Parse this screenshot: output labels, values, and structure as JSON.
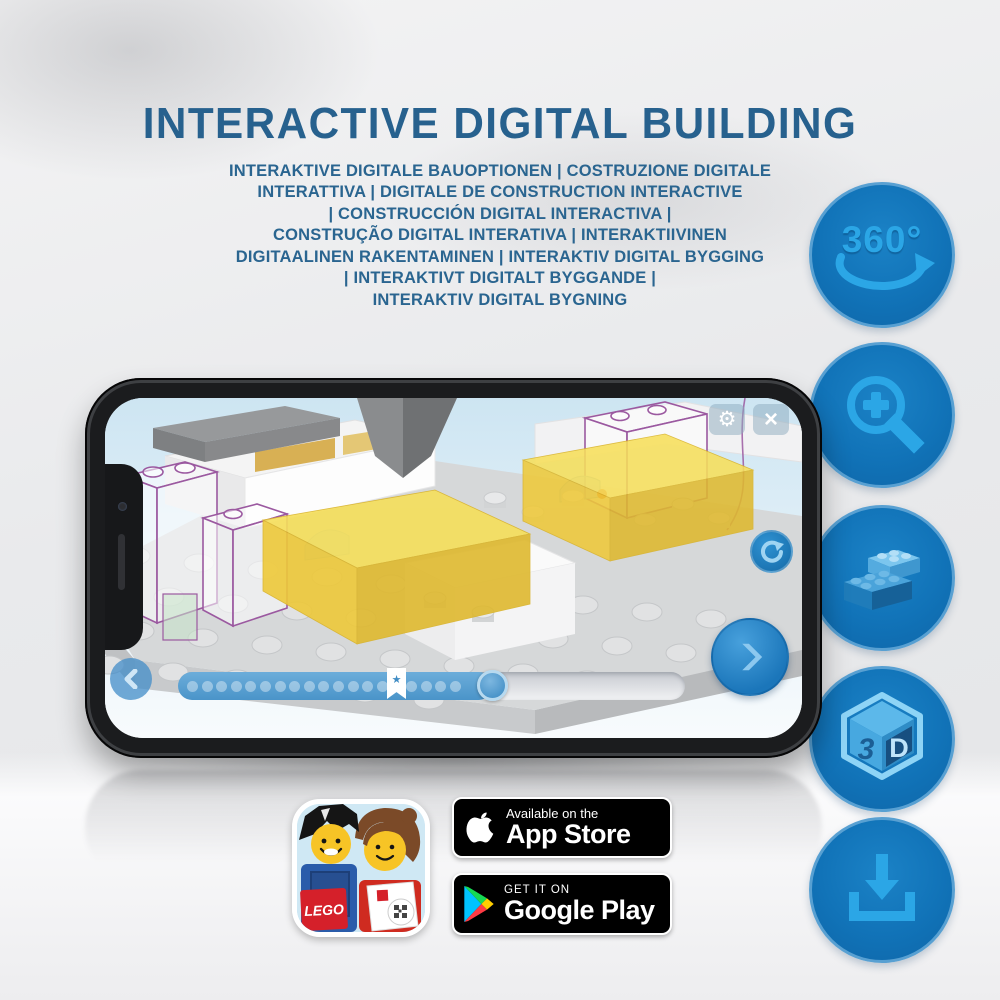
{
  "header": {
    "title": "INTERACTIVE DIGITAL BUILDING",
    "subtitle_lines": [
      "INTERAKTIVE DIGITALE BAUOPTIONEN | COSTRUZIONE DIGITALE",
      "INTERATTIVA | DIGITALE DE CONSTRUCTION INTERACTIVE",
      "| CONSTRUCCIÓN DIGITAL INTERACTIVA |",
      "CONSTRUÇÃO DIGITAL INTERATIVA | INTERAKTIIVINEN",
      "DIGITAALINEN RAKENTAMINEN | INTERAKTIV DIGITAL BYGGING",
      "| INTERAKTIVT DIGITALT BYGGANDE |",
      "INTERAKTIV DIGITAL BYGNING"
    ]
  },
  "feature_icons": [
    {
      "id": "360-rotation",
      "text": "360°"
    },
    {
      "id": "zoom-in"
    },
    {
      "id": "brick-stack"
    },
    {
      "id": "3d-cube",
      "face_left": "3",
      "face_right": "D"
    },
    {
      "id": "download"
    }
  ],
  "phone_app": {
    "icons": {
      "settings": "⚙",
      "close": "×",
      "bookmark_star": "★"
    },
    "progress": {
      "percent_complete": 62,
      "step_dots": 19,
      "bookmark_position_percent": 43
    }
  },
  "badges": {
    "app_store": {
      "tagline": "Available on the",
      "store": "App Store"
    },
    "google_play": {
      "tagline": "GET IT ON",
      "store": "Google Play"
    }
  },
  "app_icon": {
    "logo": "LEGO"
  },
  "colors": {
    "title_blue": "#27618e",
    "circle_blue": "#1173b8",
    "circle_glyph_blue": "#2ba6e6",
    "progress_blue": "#4a94c9",
    "brick_yellow": "#f0d64f",
    "ghost_outline_purple": "#9b59a0"
  }
}
